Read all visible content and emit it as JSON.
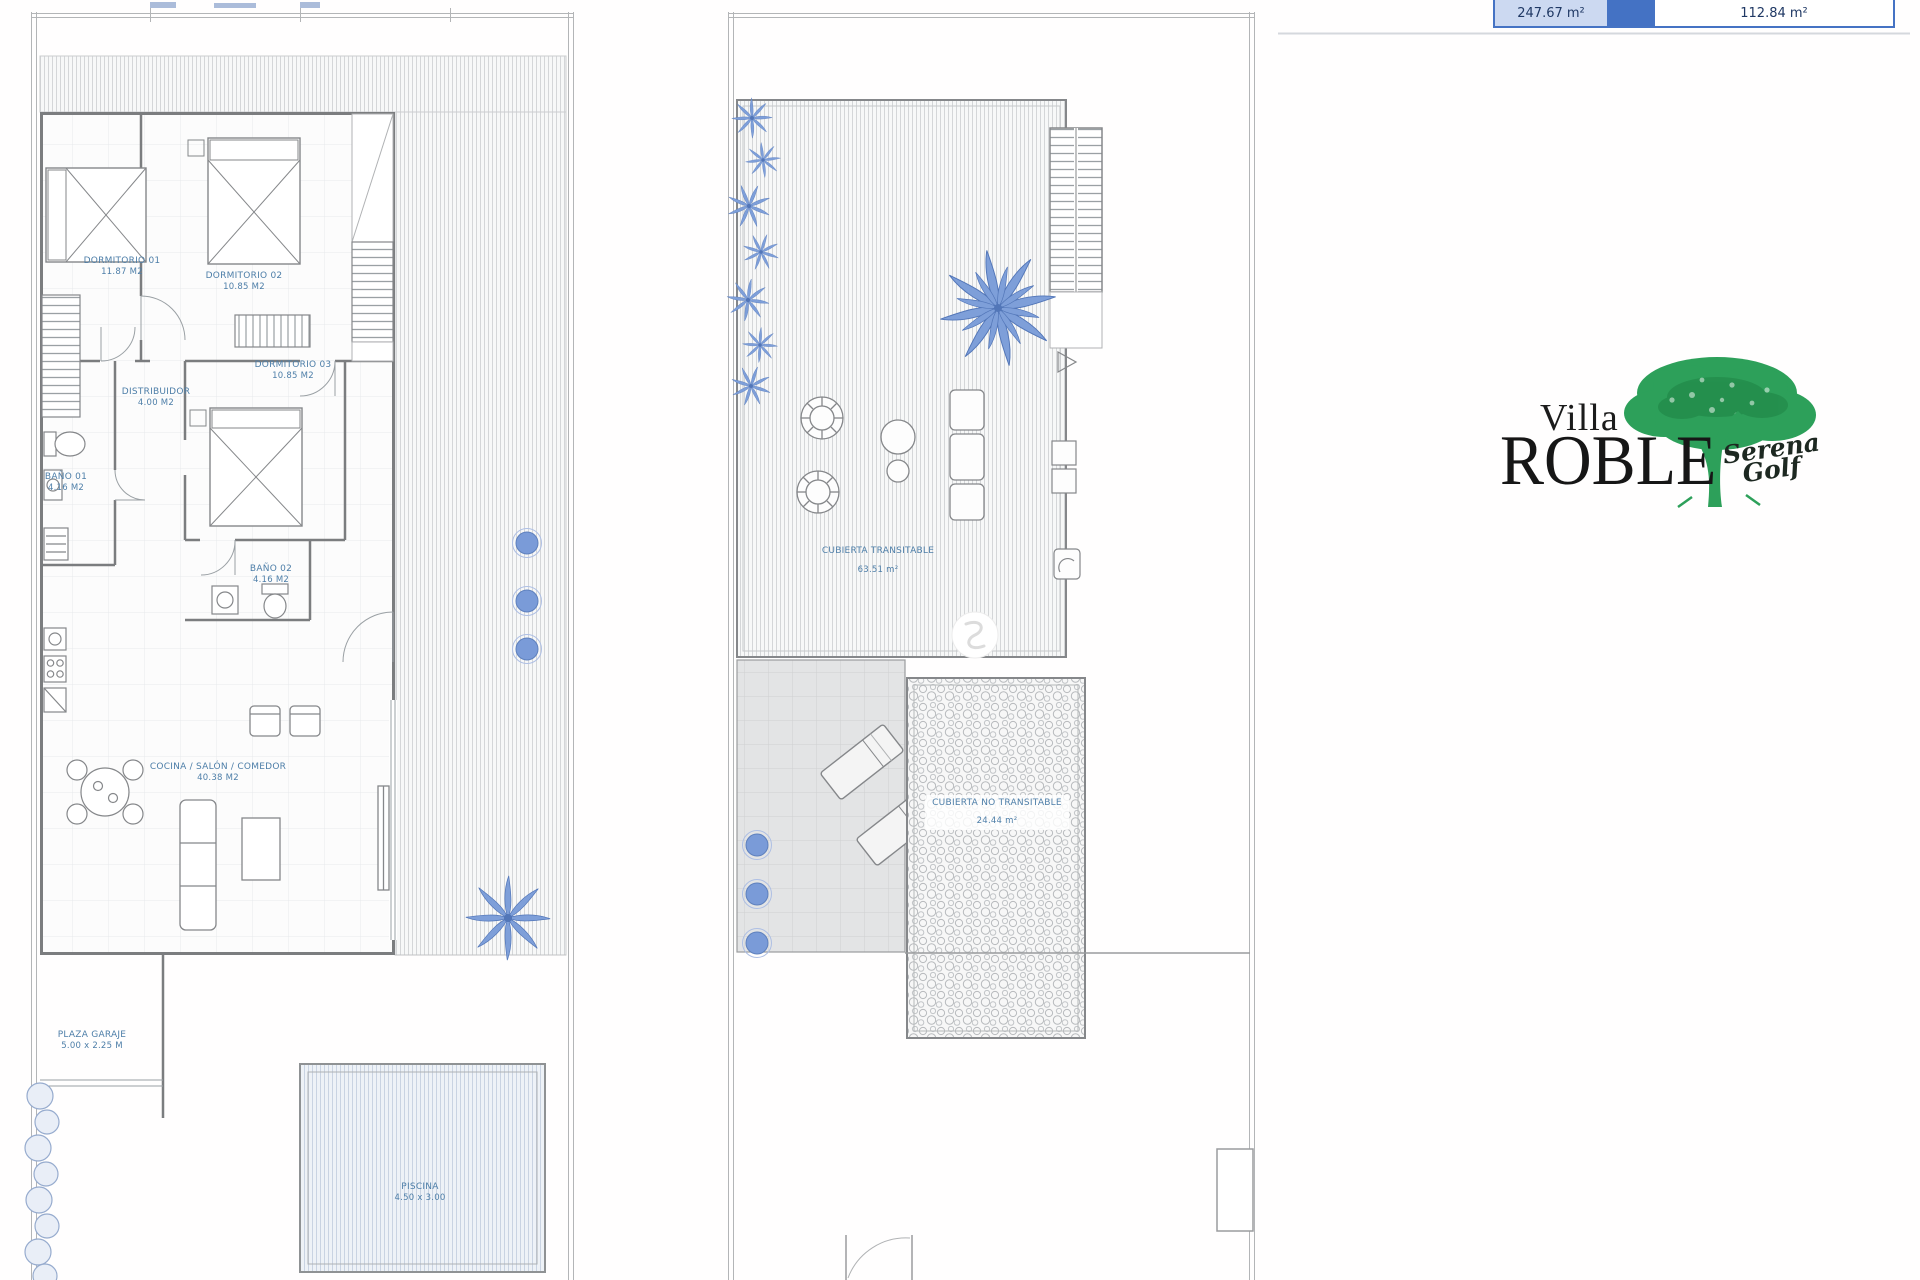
{
  "header_table": {
    "left_area": "247.67 m²",
    "right_area": "112.84 m²"
  },
  "logo": {
    "villa": "Villa",
    "roble": "ROBLE",
    "serena": "Serena",
    "golf": "Golf"
  },
  "ground_floor": {
    "dorm1": {
      "name": "DORMITORIO 01",
      "area": "11.87 M2"
    },
    "dorm2": {
      "name": "DORMITORIO 02",
      "area": "10.85 M2"
    },
    "dorm3": {
      "name": "DORMITORIO 03",
      "area": "10.85 M2"
    },
    "distribuidor": {
      "name": "DISTRIBUIDOR",
      "area": "4.00 M2"
    },
    "bano1": {
      "name": "BAÑO 01",
      "area": "4.16 M2"
    },
    "bano2": {
      "name": "BAÑO 02",
      "area": "4.16 M2"
    },
    "cocina": {
      "name": "COCINA / SALÓN / COMEDOR",
      "area": "40.38 M2"
    },
    "garaje": {
      "name": "PLAZA GARAJE",
      "area": "5.00 x 2.25 M"
    },
    "piscina": {
      "name": "PISCINA",
      "area": "4.50 x 3.00"
    }
  },
  "roof": {
    "transitable": {
      "name": "CUBIERTA TRANSITABLE",
      "area": "63.51 m²"
    },
    "no_transitable": {
      "name": "CUBIERTA NO TRANSITABLE",
      "area": "24.44 m²"
    }
  },
  "colors": {
    "accent_blue": "#4472c4",
    "table_cell_blue": "#ccd9f1",
    "label_blue": "#4d7ea8",
    "deco_blue": "#7a9bd8",
    "tree_green": "#2da05a",
    "wall_gray": "#7b7d7f"
  }
}
